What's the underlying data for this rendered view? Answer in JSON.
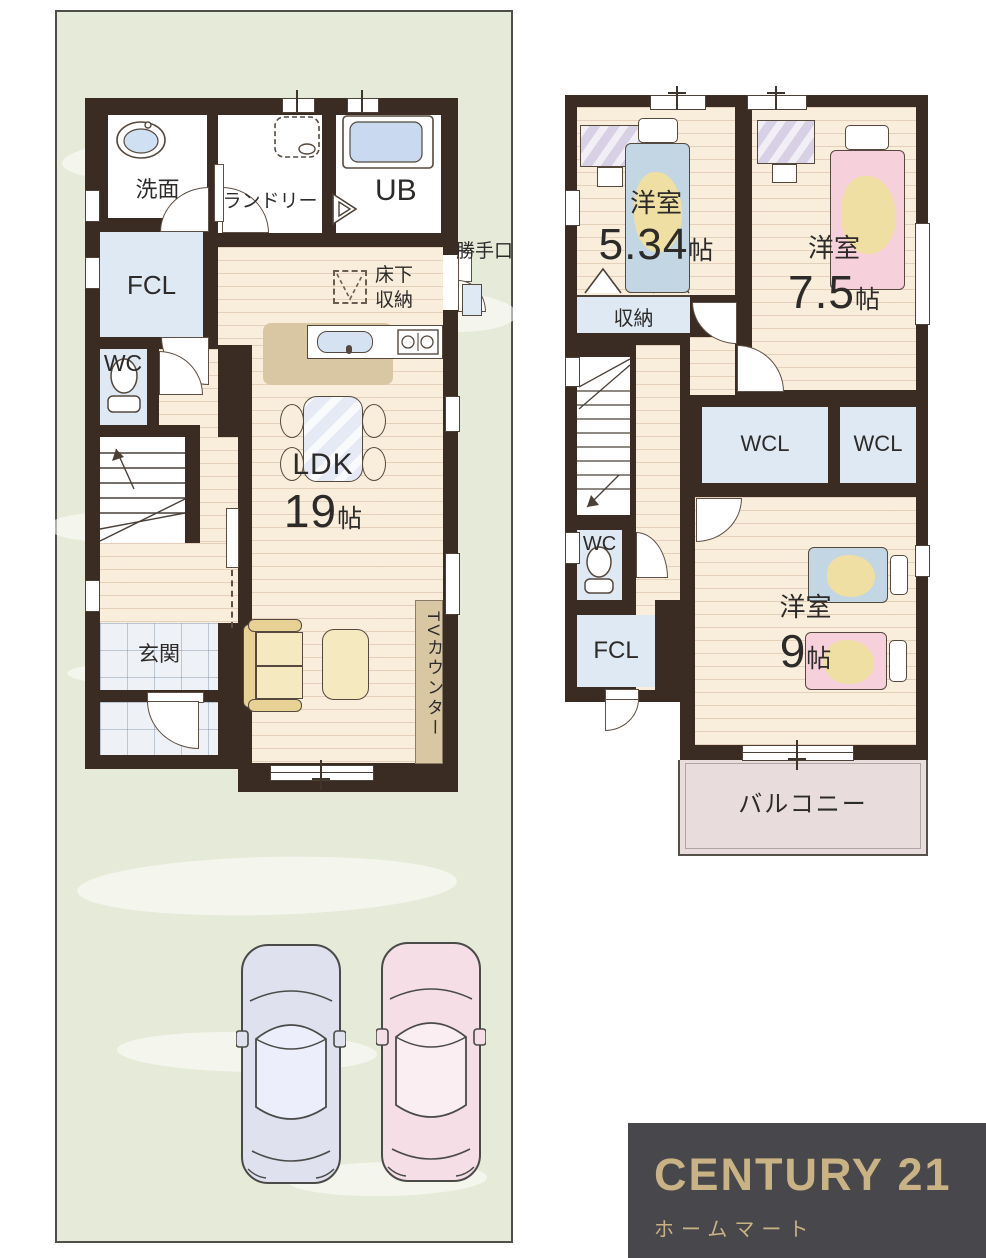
{
  "colors": {
    "wall": "#3a2c22",
    "plot-green": "#e6ead8",
    "wood": "#f9eddc",
    "room-white": "#ffffff",
    "closet-blue": "#dfe9f4",
    "tile": "#eef2f7",
    "balcony-pink": "#e8dcdd",
    "counter-tan": "#d9c7a3",
    "sofa-yellow": "#f5e9c0",
    "bed-blue": "#c2d6e4",
    "bed-pink": "#f6d0da",
    "blanket-yellow": "#f0dfa2",
    "table-blue": "#e6eaf5",
    "desk-purple": "#d8d0e4",
    "car-blue": "#dfe1ef",
    "car-pink": "#f5dee6",
    "logo-bg": "#48474b",
    "logo-gold": "#c9b384",
    "label-ink": "#2d2b29"
  },
  "floor1": {
    "washroom_label": "洗面",
    "laundry_label": "ランドリー",
    "bath_label": "UB",
    "back_door_label": "勝手口",
    "fcl_label": "FCL",
    "underfloor_line1": "床下",
    "underfloor_line2": "収納",
    "wc_label": "WC",
    "ldk_label": "LDK",
    "ldk_num": "19",
    "ldk_unit": "帖",
    "entrance_label": "玄関",
    "tv_counter_label": "TVカウンター"
  },
  "floor2": {
    "bedroom1_label": "洋室",
    "bedroom1_num": "5.34",
    "bedroom1_unit": "帖",
    "bedroom2_label": "洋室",
    "bedroom2_num": "7.5",
    "bedroom2_unit": "帖",
    "storage_label": "収納",
    "wcl_left_label": "WCL",
    "wcl_right_label": "WCL",
    "wc_label": "WC",
    "fcl_label": "FCL",
    "bedroom3_label": "洋室",
    "bedroom3_num": "9",
    "bedroom3_unit": "帖",
    "balcony_label": "バルコニー"
  },
  "logo": {
    "brand": "CENTURY 21",
    "company": "ホームマート"
  }
}
